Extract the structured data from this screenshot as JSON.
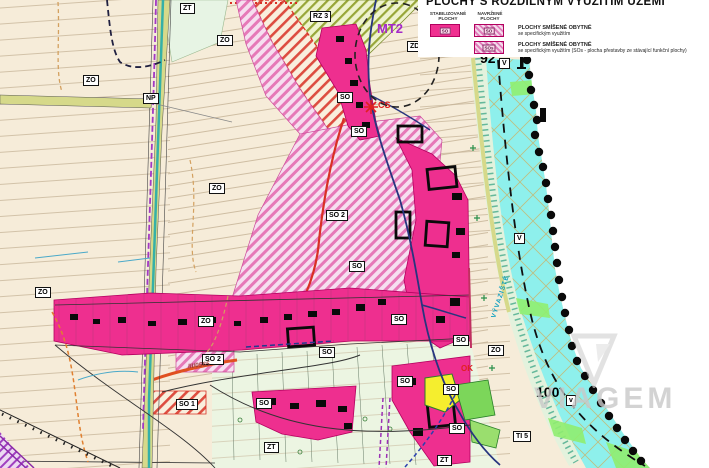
{
  "legend": {
    "title": "PLOCHY S ROZDÍLNÝM VYUŽITÍM ÚZEMÍ",
    "col_stabilized": "STABILIZOVANÉ\nPLOCHY",
    "col_proposed": "NAVRŽENÉ\nPLOCHY",
    "rows": [
      {
        "swatch_code_stabilized": "SO",
        "swatch_code_proposed": "SO",
        "label_line1": "PLOCHY SMÍŠENÉ OBYTNÉ",
        "label_line2": "se specifickým využitím"
      },
      {
        "swatch_code_proposed": "SOs",
        "label_line1": "PLOCHY SMÍŠENÉ OBYTNÉ",
        "label_line2": "se specifickým využitím (SOs - plocha přestavby ze stávající funkční plochy)"
      }
    ]
  },
  "map": {
    "labels": [
      {
        "text": "ZT"
      },
      {
        "text": "RZ 3"
      },
      {
        "text": "ZO"
      },
      {
        "text": "ZO"
      },
      {
        "text": "NP"
      },
      {
        "text": "ZO"
      },
      {
        "text": "SO"
      },
      {
        "text": "SO"
      },
      {
        "text": "SO 2"
      },
      {
        "text": "SO"
      },
      {
        "text": "ZO"
      },
      {
        "text": "ZO"
      },
      {
        "text": "SO 2"
      },
      {
        "text": "SO 1"
      },
      {
        "text": "SO"
      },
      {
        "text": "SO"
      },
      {
        "text": "SO"
      },
      {
        "text": "SO"
      },
      {
        "text": "SO"
      },
      {
        "text": "SO"
      },
      {
        "text": "SO"
      },
      {
        "text": "ZO"
      },
      {
        "text": "ZT"
      },
      {
        "text": "ZT"
      },
      {
        "text": "TI 5"
      },
      {
        "text": "ZD"
      },
      {
        "text": "V"
      },
      {
        "text": "V"
      },
      {
        "text": "v"
      },
      {
        "text": "92"
      },
      {
        "text": "100"
      },
      {
        "text": "MT2"
      },
      {
        "text": "CS"
      },
      {
        "text": "OK"
      },
      {
        "text": "III/0565"
      },
      {
        "text": "VÝVAZIŠTĚ"
      }
    ]
  },
  "watermark": {
    "text": "VIAGEM"
  },
  "colors": {
    "stabilized_magenta": "#ee2f8f",
    "proposed_hatch_pink": "#e07fbb",
    "river_cyan": "#8ef0ec",
    "base_beige": "#f6ecd9",
    "boundary_black": "#111111",
    "corridor_purple": "#a238c4",
    "note_red": "#e02020"
  }
}
